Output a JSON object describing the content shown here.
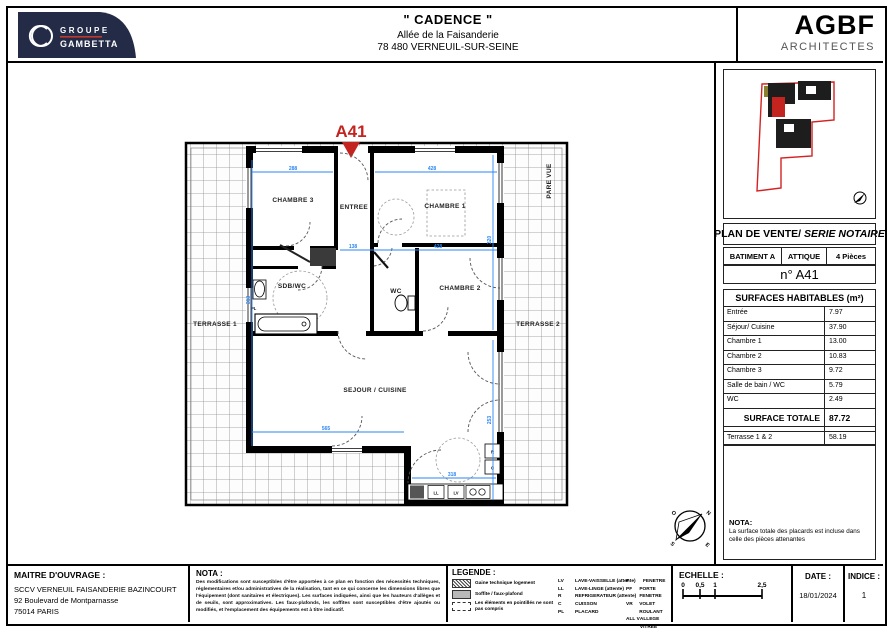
{
  "header": {
    "project_title": "\" CADENCE \"",
    "address_line1": "Allée de la Faisanderie",
    "address_line2": "78 480 VERNEUIL-SUR-SEINE",
    "developer_logo": {
      "line1": "GROUPE",
      "line2": "GAMBETTA"
    },
    "architect_logo": {
      "name": "AGBF",
      "subtitle": "ARCHITECTES"
    }
  },
  "side_panel": {
    "plan_title": "PLAN DE VENTE/",
    "plan_title_italic": " SERIE NOTAIRE",
    "batiment": "BATIMENT A",
    "etage": "ATTIQUE",
    "pieces": "4 Pièces",
    "lot": "n° A41",
    "surfaces_title": "SURFACES HABITABLES (m²)",
    "surfaces": [
      {
        "label": "Entrée",
        "value": "7.97"
      },
      {
        "label": "Séjour/ Cuisine",
        "value": "37.90"
      },
      {
        "label": "Chambre 1",
        "value": "13.00"
      },
      {
        "label": "Chambre 2",
        "value": "10.83"
      },
      {
        "label": "Chambre 3",
        "value": "9.72"
      },
      {
        "label": "Salle de bain / WC",
        "value": "5.79"
      },
      {
        "label": "WC",
        "value": "2.49"
      }
    ],
    "total_label": "SURFACE TOTALE",
    "total_value": "87.72",
    "terrasse_label": "Terrasse 1 & 2",
    "terrasse_value": "58.19",
    "nota_title": "NOTA:",
    "nota_text": "La surface totale des placards est incluse dans celle des pièces attenantes"
  },
  "plan": {
    "unit_marker": "A41",
    "rooms": {
      "chambre3": "CHAMBRE 3",
      "entree": "ENTREE",
      "chambre1": "CHAMBRE 1",
      "sdb": "SDB/WC",
      "wc": "WC",
      "chambre2": "CHAMBRE 2",
      "sejour": "SEJOUR / CUISINE",
      "terrasse1": "TERRASSE 1",
      "terrasse2": "TERRASSE 2"
    },
    "pare_vue": "PARE VUE",
    "appliances": {
      "ll": "LL",
      "lv": "LV",
      "r": "R",
      "c": "C",
      "pl": "PL"
    },
    "dims": {
      "h1": "288",
      "h2": "428",
      "h3": "138",
      "h4": "428",
      "h5": "565",
      "h6": "318",
      "v1": "313",
      "v2": "320",
      "v3": "253"
    },
    "compass": {
      "n": "N",
      "e": "E",
      "s": "S",
      "o": "O"
    }
  },
  "footer": {
    "maitre_title": "MAITRE D'OUVRAGE :",
    "maitre_lines": [
      "SCCV VERNEUIL FAISANDERIE BAZINCOURT",
      "92 Boulevard de Montparnasse",
      "75014 PARIS"
    ],
    "nota_title": "NOTA :",
    "nota_text": "Des modifications sont susceptibles d'être apportées à ce plan en fonction des nécessités techniques, réglementaires et/ou administratives de la réalisation, tant en ce qui concerne les dimensions libres que l'équipement (dont sanitaires et électriques). Les surfaces indiquées, ainsi que les hauteurs d'allèges et de seuils, sont approximatives. Les faux-plafonds, les soffites sont susceptibles d'être ajoutés ou modifiés, et l'emplacement des équipements est à titre indicatif.",
    "legende_title": "LEGENDE :",
    "legende_items": [
      {
        "label": "Gaine technique logement"
      },
      {
        "label": "Soffite / faux-plafond"
      },
      {
        "label": "Les éléments en pointillés ne sont pas compris"
      }
    ],
    "legende_equip": [
      {
        "abbr": "LV",
        "label": "LAVE-VAISSELLE (attente)"
      },
      {
        "abbr": "LL",
        "label": "LAVE-LINGE (attente)"
      },
      {
        "abbr": "R",
        "label": "REFRIGERATEUR (attente)"
      },
      {
        "abbr": "C",
        "label": "CUISSON"
      },
      {
        "abbr": "PL",
        "label": "PLACARD"
      }
    ],
    "legende_menuiserie": [
      {
        "abbr": "F",
        "label": "FENETRE"
      },
      {
        "abbr": "PF",
        "label": "PORTE FENETRE"
      },
      {
        "abbr": "VR",
        "label": "VOLET ROULANT"
      },
      {
        "abbr": "ALL V",
        "label": "ALLEGE VITREE"
      },
      {
        "abbr": "GC",
        "label": "GARDE CORPS"
      }
    ],
    "echelle_title": "ECHELLE :",
    "echelle_ticks": [
      "0",
      "0,5",
      "1",
      "2,5"
    ],
    "date_title": "DATE :",
    "date_value": "18/01/2024",
    "indice_title": "INDICE :",
    "indice_value": "1"
  },
  "colors": {
    "accent_red": "#c42420",
    "dimension_blue": "#2e86f5",
    "navy": "#232b47"
  }
}
